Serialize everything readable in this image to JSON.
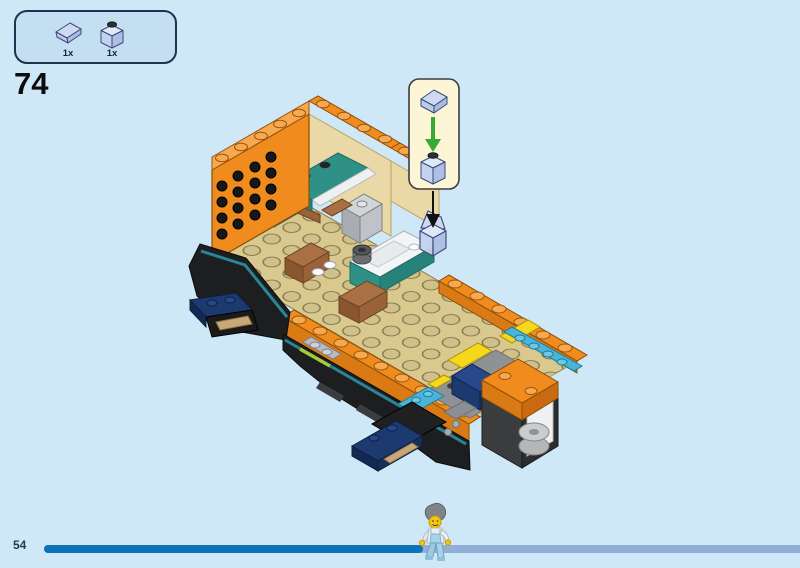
{
  "page": {
    "step_number": "74",
    "page_number": "54",
    "background_color": "#cfe8f8"
  },
  "parts_panel": {
    "items": [
      {
        "icon": "slope-1x1-part-icon",
        "count": "1x"
      },
      {
        "icon": "brick-1x1-part-icon",
        "count": "1x"
      }
    ]
  },
  "callout": {
    "pieces": [
      "slope-1x1-piece",
      "brick-1x1-piece"
    ],
    "arrow_icon": "green-down-arrow",
    "pointer_icon": "black-down-arrow",
    "fill": "#fcf5d6",
    "arrow_color": "#3aaa35"
  },
  "illustration": {
    "subject": "lego-boat-assembly-step-74",
    "colors": {
      "hull_orange": "#f08c1e",
      "deck_tan": "#d9c98f",
      "accent_teal": "#2f9186",
      "accent_azure": "#49b4d7",
      "accent_yellow": "#f6d71c",
      "accent_navy": "#1d3a70",
      "hull_black": "#1c1e20",
      "crate_brown": "#a97044",
      "accent_lime": "#a6ca3a"
    }
  },
  "progress_bar": {
    "fraction": 0.5,
    "filled_color": "#0d72b8",
    "rest_color": "#92aed6"
  },
  "palette": {
    "bg": "#cfe8f8",
    "panel_fill": "#c4def2",
    "panel_border": "#21314f",
    "step_color": "#0d0d0d",
    "page_num_color": "#1e3a54",
    "bar_fill": "#0d72b8",
    "bar_rest": "#92aed6",
    "callout_fill": "#fcf5d6",
    "callout_border": "#3c3c3c",
    "arrow_green": "#3aaa35",
    "ghost_blue": "#cfdaf2",
    "orange": "#f08c1e",
    "orange_light": "#f7a94f",
    "tan": "#d9c98f",
    "teal": "#2f9186",
    "azure": "#49b4d7",
    "yellow": "#f6d71c",
    "navy": "#1d3a70",
    "brown": "#a97044",
    "hull": "#1c1e20",
    "lime": "#a6ca3a",
    "white": "#f2f4f6",
    "gray": "#8b8e92"
  }
}
